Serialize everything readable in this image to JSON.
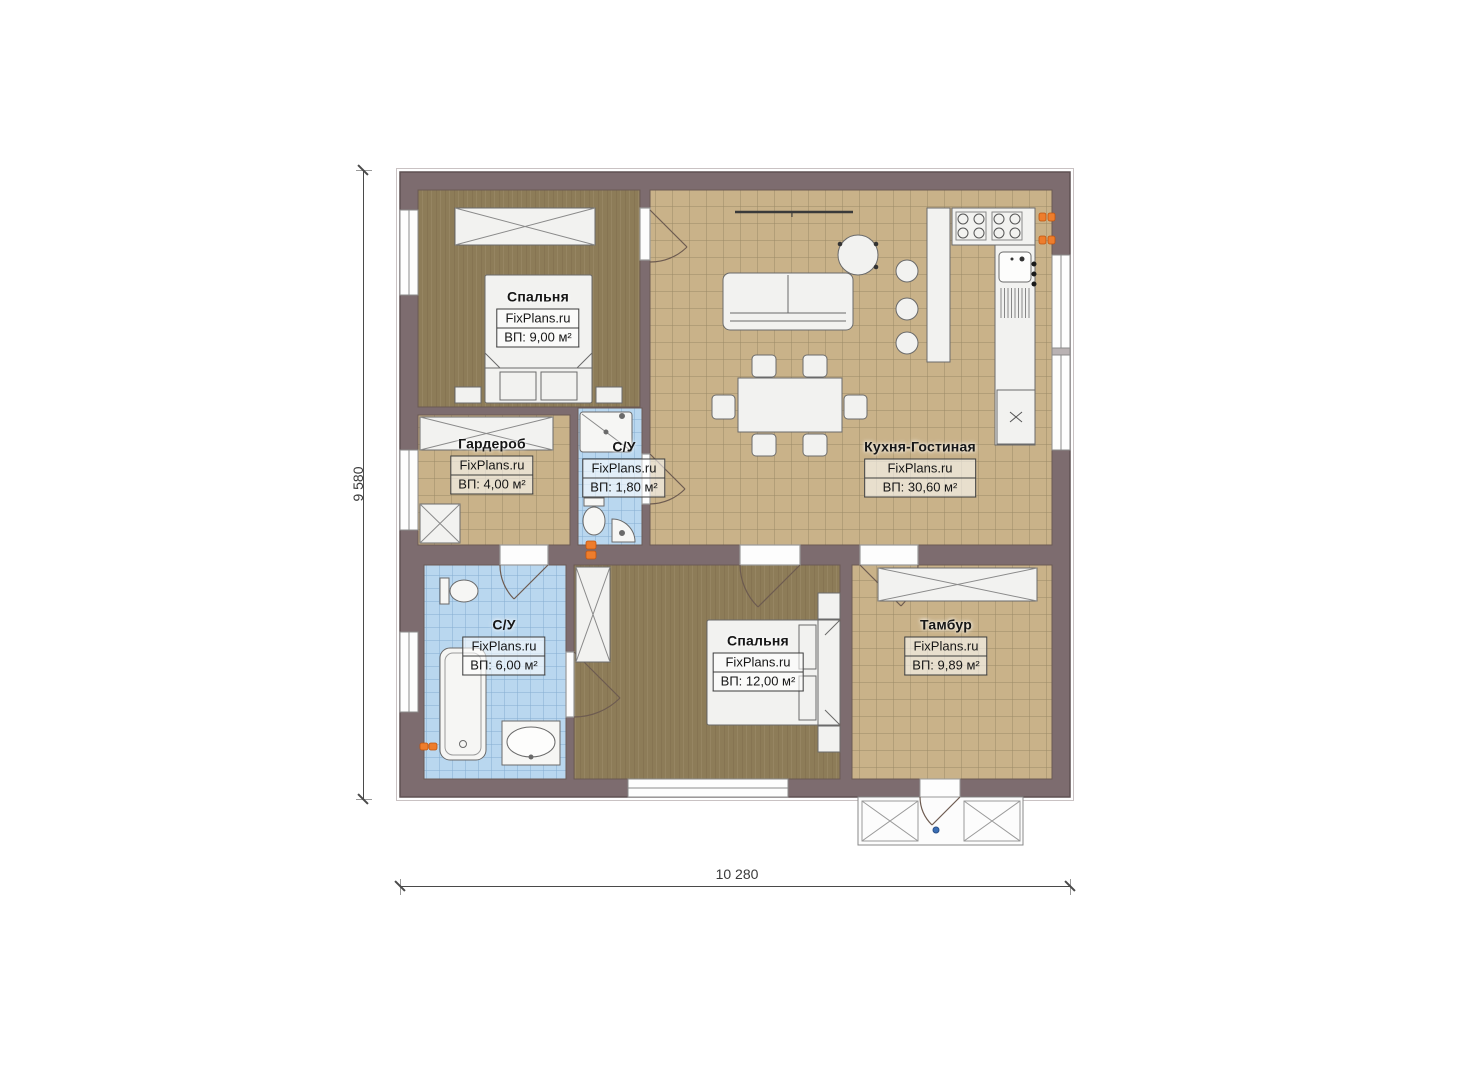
{
  "plan_title": "FixPlans.ru single-storey house floor plan",
  "watermark": "FixPlans.ru",
  "dimensions": {
    "height_label": "9 580",
    "width_label": "10 280"
  },
  "rooms": [
    {
      "id": "bedroom-top",
      "name": "Спальня",
      "watermark": "FixPlans.ru",
      "area": "ВП: 9,00 м²"
    },
    {
      "id": "wardrobe",
      "name": "Гардероб",
      "watermark": "FixPlans.ru",
      "area": "ВП: 4,00 м²"
    },
    {
      "id": "wc-small",
      "name": "С/У",
      "watermark": "FixPlans.ru",
      "area": "ВП: 1,80 м²"
    },
    {
      "id": "kitchen-living",
      "name": "Кухня-Гостиная",
      "watermark": "FixPlans.ru",
      "area": "ВП: 30,60 м²"
    },
    {
      "id": "wc-big",
      "name": "С/У",
      "watermark": "FixPlans.ru",
      "area": "ВП: 6,00 м²"
    },
    {
      "id": "bedroom-bottom",
      "name": "Спальня",
      "watermark": "FixPlans.ru",
      "area": "ВП: 12,00 м²"
    },
    {
      "id": "vestibule",
      "name": "Тамбур",
      "watermark": "FixPlans.ru",
      "area": "ВП: 9,89 м²"
    }
  ],
  "colors": {
    "wall": "#7d6c6f",
    "wall_outline": "#5e5052",
    "floor_wood": "#8d7c58",
    "floor_tile_tan": "#c9b289",
    "tile_tan_grid": "#9b8a66",
    "floor_tile_blue": "#b9d7ef",
    "tile_blue_grid": "#85aed1",
    "furniture": "#f2f2f0",
    "accent_orange": "#ee7d2c",
    "door_marker_blue": "#3b6fb5"
  }
}
